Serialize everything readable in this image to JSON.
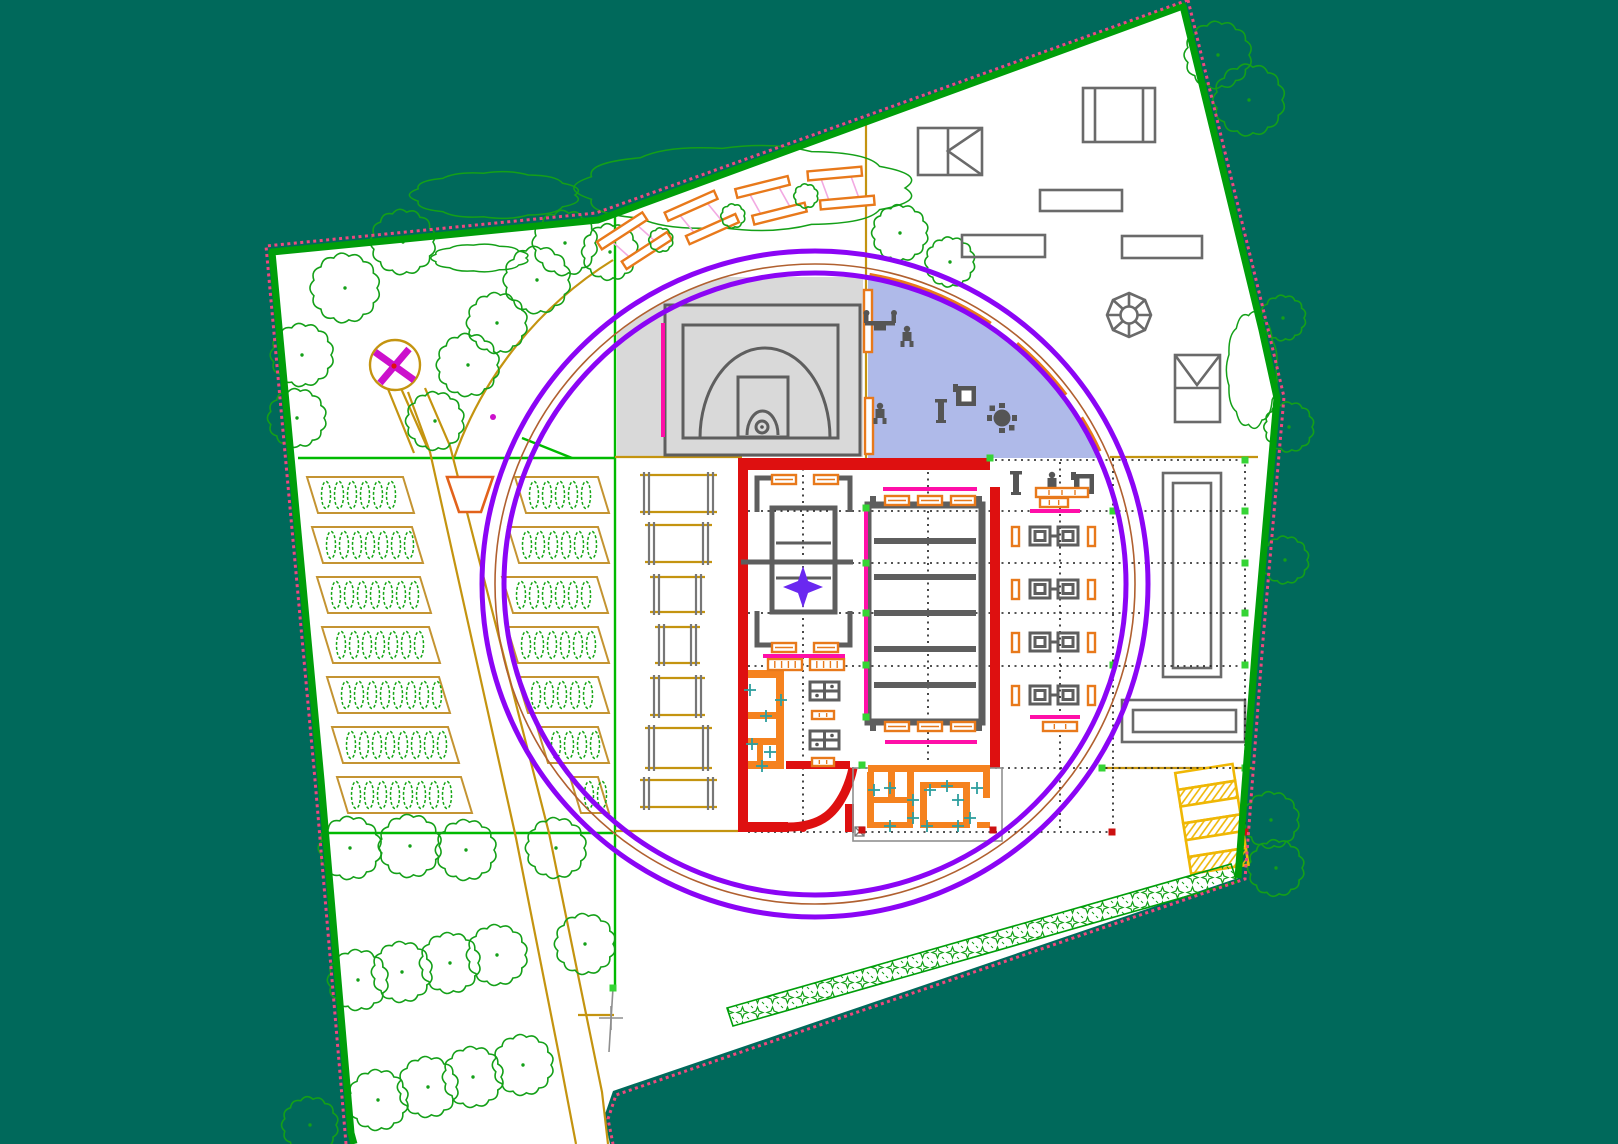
{
  "meta": {
    "title": "Landscape site plan - CAD drawing",
    "kind": "cad-site-plan",
    "visible_text": "none"
  },
  "colors": {
    "bg": "#00695B",
    "paper": "#FFFFFF",
    "boundary": "#009E0A",
    "dash": "#F0487E",
    "olive": "#C49410",
    "greenline": "#00BA00",
    "tree": "#14A018",
    "plant": "#16A616",
    "bedline": "#C49432",
    "orange": "#E8791B",
    "wall_orange": "#F5821F",
    "red": "#DE1010",
    "magenta": "#FF0FA8",
    "pink": "#F2A9E2",
    "purple": "#8B05F5",
    "maroon": "#B06030",
    "star": "#6A28F0",
    "blue": "#AFBAE9",
    "grayzone": "#D9D9D9",
    "courtline": "#5E5E5E",
    "glyph": "#555555",
    "thin": "#8F8F8F",
    "yellow": "#EFB705",
    "teal_tick": "#2E9E9E",
    "grid": "#1A1A1A",
    "mgreen": "#35D435",
    "mred": "#CC1010"
  },
  "trees": {
    "inside": [
      [
        345,
        288,
        32
      ],
      [
        302,
        355,
        29
      ],
      [
        297,
        418,
        27
      ],
      [
        403,
        242,
        30
      ],
      [
        468,
        365,
        29
      ],
      [
        497,
        323,
        28
      ],
      [
        537,
        280,
        31
      ],
      [
        565,
        243,
        30
      ],
      [
        610,
        252,
        26
      ],
      [
        435,
        421,
        27
      ],
      [
        900,
        233,
        26
      ],
      [
        950,
        262,
        23
      ],
      [
        350,
        848,
        29
      ],
      [
        410,
        846,
        29
      ],
      [
        466,
        850,
        28
      ],
      [
        556,
        848,
        28
      ],
      [
        585,
        944,
        28
      ],
      [
        358,
        980,
        28
      ],
      [
        402,
        972,
        28
      ],
      [
        450,
        963,
        28
      ],
      [
        497,
        955,
        28
      ],
      [
        378,
        1100,
        28
      ],
      [
        428,
        1087,
        28
      ],
      [
        473,
        1077,
        28
      ],
      [
        523,
        1065,
        28
      ],
      [
        310,
        1125,
        26
      ]
    ],
    "outside": [
      [
        1218,
        55,
        31
      ],
      [
        1249,
        100,
        33
      ],
      [
        1283,
        318,
        21
      ],
      [
        1289,
        427,
        23
      ],
      [
        1285,
        560,
        22
      ],
      [
        1271,
        820,
        26
      ],
      [
        1276,
        868,
        26
      ]
    ]
  },
  "clouds": [
    [
      495,
      195,
      80,
      22
    ],
    [
      745,
      188,
      160,
      40
    ],
    [
      480,
      258,
      46,
      13
    ],
    [
      1252,
      370,
      24,
      55
    ]
  ],
  "beds": {
    "left": [
      [
        307,
        477,
        96
      ],
      [
        312,
        527,
        100
      ],
      [
        317,
        577,
        103
      ],
      [
        322,
        627,
        107
      ],
      [
        327,
        677,
        112
      ],
      [
        332,
        727,
        116
      ],
      [
        337,
        777,
        124
      ]
    ],
    "right": [
      [
        515,
        477,
        83
      ],
      [
        508,
        527,
        90
      ],
      [
        502,
        577,
        95
      ],
      [
        507,
        627,
        91
      ],
      [
        517,
        677,
        81
      ],
      [
        537,
        727,
        61
      ],
      [
        570,
        777,
        28
      ]
    ]
  },
  "pergolas": [
    [
      640,
      475,
      77,
      37
    ],
    [
      645,
      525,
      67,
      37
    ],
    [
      650,
      577,
      55,
      35
    ],
    [
      655,
      627,
      45,
      36
    ],
    [
      650,
      678,
      55,
      37
    ],
    [
      645,
      728,
      67,
      40
    ],
    [
      640,
      780,
      77,
      27
    ]
  ],
  "bench_groups": [
    [
      630,
      243,
      -33
    ],
    [
      697,
      219,
      -24
    ],
    [
      766,
      201,
      -14
    ],
    [
      836,
      188,
      -5
    ]
  ],
  "bushes": [
    [
      661,
      240,
      11
    ],
    [
      733,
      216,
      11
    ],
    [
      806,
      196,
      11
    ]
  ],
  "park_benches": [
    [
      772,
      475
    ],
    [
      814,
      475
    ],
    [
      772,
      643
    ],
    [
      814,
      643
    ],
    [
      885,
      496
    ],
    [
      918,
      496
    ],
    [
      951,
      496
    ],
    [
      885,
      722
    ],
    [
      918,
      722
    ],
    [
      951,
      722
    ]
  ],
  "tick_rects": [
    [
      768,
      659,
      34,
      11,
      4
    ],
    [
      810,
      659,
      34,
      11,
      4
    ],
    [
      812,
      711,
      22,
      8,
      2
    ],
    [
      812,
      758,
      22,
      8,
      2
    ],
    [
      1040,
      498,
      28,
      9,
      2
    ],
    [
      1043,
      722,
      34,
      9,
      2
    ],
    [
      1036,
      488,
      52,
      9,
      3
    ]
  ],
  "machine_rows": [
    527,
    580,
    633,
    686
  ],
  "grid": {
    "h": [
      [
        460,
        995,
        1245
      ],
      [
        511,
        748,
        1245
      ],
      [
        563,
        748,
        1245
      ],
      [
        613,
        748,
        1245
      ],
      [
        666,
        748,
        1245
      ],
      [
        768,
        748,
        1245
      ],
      [
        832,
        748,
        1118
      ]
    ],
    "v": [
      [
        803,
        462,
        830
      ],
      [
        928,
        472,
        764
      ],
      [
        1060,
        462,
        830
      ],
      [
        1113,
        458,
        830
      ],
      [
        1245,
        458,
        830
      ]
    ]
  },
  "squares_green": [
    [
      866,
      508
    ],
    [
      866,
      563
    ],
    [
      866,
      613
    ],
    [
      866,
      665
    ],
    [
      866,
      717
    ],
    [
      990,
      458
    ],
    [
      1245,
      460
    ],
    [
      1245,
      511
    ],
    [
      1245,
      563
    ],
    [
      1245,
      613
    ],
    [
      1245,
      665
    ],
    [
      1245,
      768
    ],
    [
      1113,
      511
    ],
    [
      1113,
      665
    ],
    [
      1102,
      768
    ],
    [
      613,
      988
    ],
    [
      862,
      765
    ]
  ],
  "markers_red": [
    [
      1112,
      832
    ],
    [
      1245,
      832
    ],
    [
      993,
      830
    ],
    [
      862,
      830
    ]
  ],
  "magenta_bars": [
    [
      883,
      489,
      977,
      489
    ],
    [
      885,
      742,
      977,
      742
    ],
    [
      763,
      656,
      845,
      656
    ],
    [
      1030,
      511,
      1080,
      511
    ],
    [
      1030,
      717,
      1080,
      717
    ]
  ],
  "magenta_lines": [
    [
      866,
      505,
      866,
      720
    ],
    [
      663,
      323,
      663,
      437
    ]
  ],
  "teal_ticks": [
    [
      750,
      690
    ],
    [
      781,
      700
    ],
    [
      766,
      716
    ],
    [
      752,
      744
    ],
    [
      770,
      752
    ],
    [
      762,
      766
    ],
    [
      874,
      790
    ],
    [
      890,
      788
    ],
    [
      913,
      800
    ],
    [
      930,
      790
    ],
    [
      947,
      786
    ],
    [
      958,
      800
    ],
    [
      977,
      788
    ],
    [
      890,
      826
    ],
    [
      927,
      826
    ],
    [
      958,
      826
    ],
    [
      913,
      818
    ],
    [
      970,
      818
    ]
  ]
}
